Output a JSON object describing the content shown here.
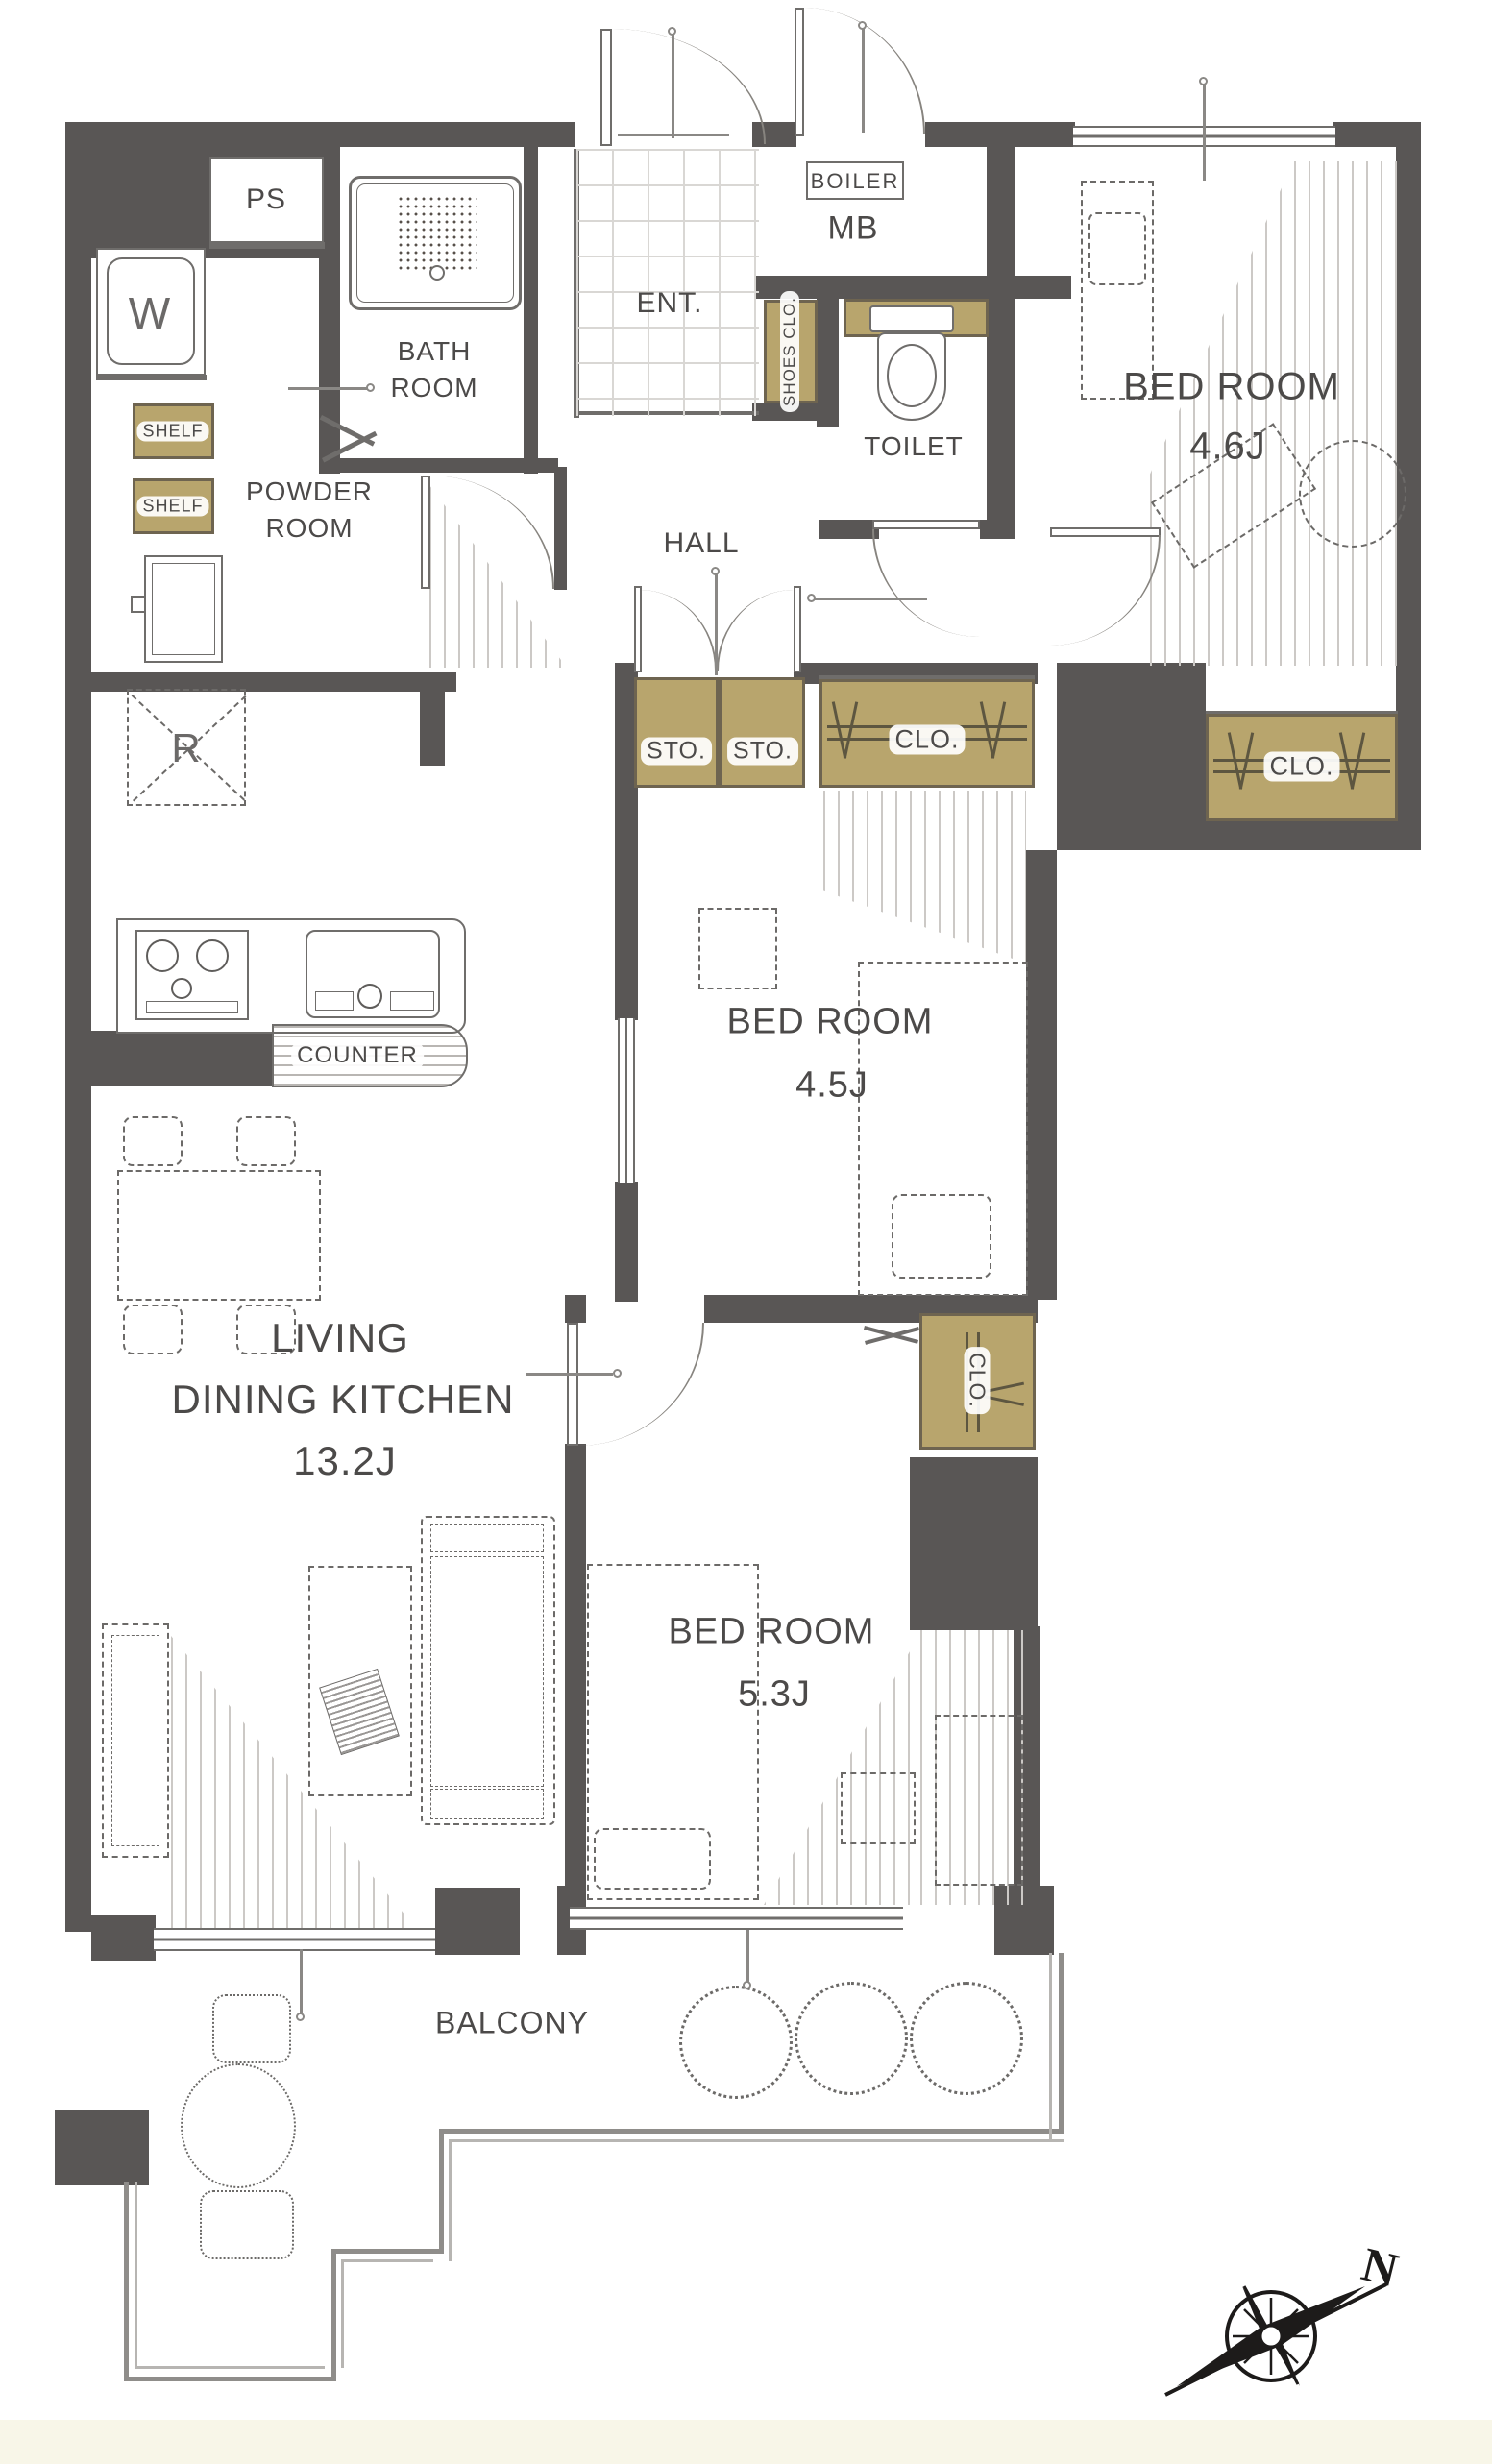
{
  "title": "apartment floor plan",
  "palette": {
    "wall": "#595655",
    "closet": "#b8a56d",
    "paper": "#ffffff",
    "mat": "#f8f6e8",
    "line": "#6f6d6b",
    "text": "#4c4a49"
  },
  "rooms": {
    "bedroom_a": {
      "label": "BED ROOM",
      "size": "4.6J"
    },
    "bedroom_b": {
      "label": "BED ROOM",
      "size": "4.5J"
    },
    "bedroom_c": {
      "label": "BED ROOM",
      "size": "5.3J"
    },
    "living": {
      "line1": "LIVING",
      "line2": "DINING KITCHEN",
      "size": "13.2J"
    },
    "hall": {
      "label": "HALL"
    },
    "entrance": {
      "label": "ENT."
    },
    "toilet": {
      "label": "TOILET"
    },
    "bathroom": {
      "line1": "BATH",
      "line2": "ROOM"
    },
    "powder": {
      "line1": "POWDER",
      "line2": "ROOM"
    },
    "balcony": {
      "label": "BALCONY"
    }
  },
  "storage": {
    "shoes": "SHOES CLO.",
    "sto": "STO.",
    "clo": "CLO.",
    "shelf": "SHELF"
  },
  "fixtures": {
    "ps": "PS",
    "washer": "W",
    "fridge": "R",
    "boiler": "BOILER",
    "meter_box": "MB",
    "counter": "COUNTER"
  },
  "compass": {
    "north": "N"
  }
}
